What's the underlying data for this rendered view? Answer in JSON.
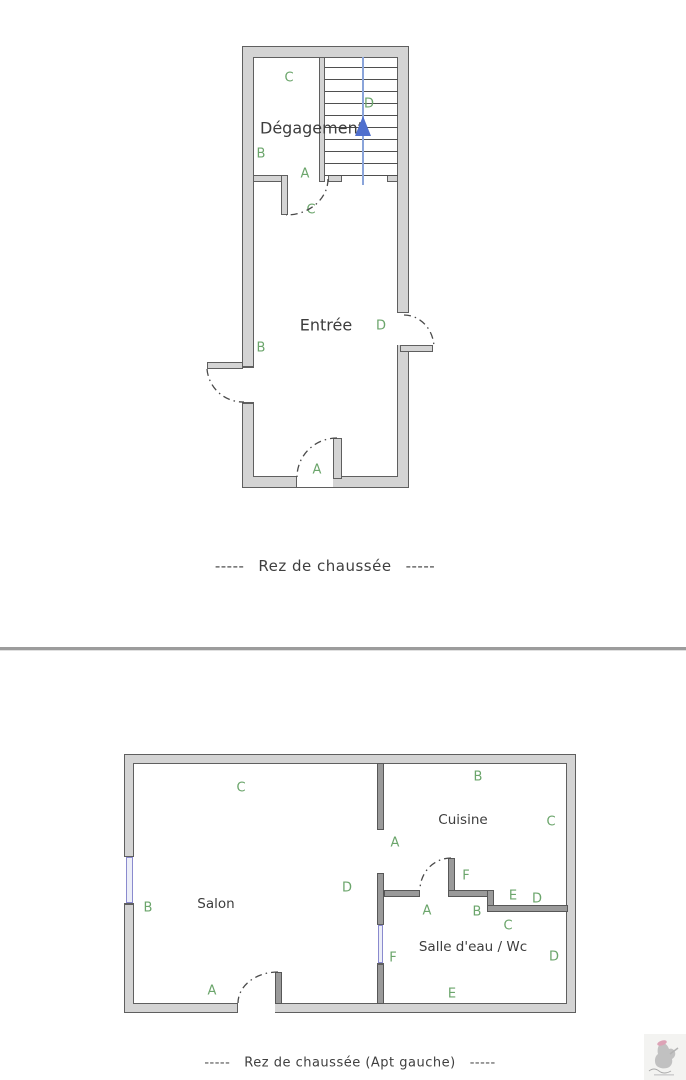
{
  "colors": {
    "wall_fill": "#d4d4d4",
    "wall_stroke": "#5f5f5f",
    "interior_wall": "#9a9a9a",
    "label_green": "#6ba56b",
    "text_dark": "#3d3d3d",
    "stair_line_blue": "#8aa4da",
    "stair_arrow_blue": "#4f6fce",
    "window_purple": "#8a8ace",
    "divider_gray": "#9c9c9c"
  },
  "plan_ground_floor": {
    "caption": {
      "dashes": "-----",
      "text": "Rez de chaussée"
    },
    "rooms": [
      {
        "name": "Dégagement"
      },
      {
        "name": "Entrée"
      }
    ],
    "stair": {
      "icon": "stair-direction-arrow",
      "treads": 10
    },
    "door_labels": [
      {
        "text": "C",
        "x": 289,
        "y": 78
      },
      {
        "text": "D",
        "x": 369,
        "y": 104
      },
      {
        "text": "B",
        "x": 261,
        "y": 154
      },
      {
        "text": "A",
        "x": 305,
        "y": 174
      },
      {
        "text": "C",
        "x": 311,
        "y": 210
      },
      {
        "text": "B",
        "x": 261,
        "y": 348
      },
      {
        "text": "D",
        "x": 381,
        "y": 326
      },
      {
        "text": "A",
        "x": 317,
        "y": 470
      }
    ]
  },
  "plan_apt_gauche": {
    "caption": {
      "dashes": "-----",
      "text": "Rez de chaussée (Apt gauche)"
    },
    "rooms": [
      {
        "name": "Salon"
      },
      {
        "name": "Cuisine"
      },
      {
        "name": "Salle d'eau / Wc"
      }
    ],
    "door_labels": [
      {
        "text": "C",
        "x": 241,
        "y": 788
      },
      {
        "text": "B",
        "x": 478,
        "y": 777
      },
      {
        "text": "C",
        "x": 551,
        "y": 822
      },
      {
        "text": "A",
        "x": 395,
        "y": 843
      },
      {
        "text": "D",
        "x": 347,
        "y": 888
      },
      {
        "text": "F",
        "x": 466,
        "y": 876
      },
      {
        "text": "E",
        "x": 513,
        "y": 896
      },
      {
        "text": "D",
        "x": 537,
        "y": 899
      },
      {
        "text": "A",
        "x": 427,
        "y": 911
      },
      {
        "text": "B",
        "x": 477,
        "y": 912
      },
      {
        "text": "C",
        "x": 508,
        "y": 926
      },
      {
        "text": "D",
        "x": 554,
        "y": 957
      },
      {
        "text": "F",
        "x": 393,
        "y": 958
      },
      {
        "text": "B",
        "x": 148,
        "y": 908
      },
      {
        "text": "A",
        "x": 212,
        "y": 991
      },
      {
        "text": "E",
        "x": 452,
        "y": 994
      }
    ]
  },
  "watermark": {
    "icon": "agency-logo"
  }
}
